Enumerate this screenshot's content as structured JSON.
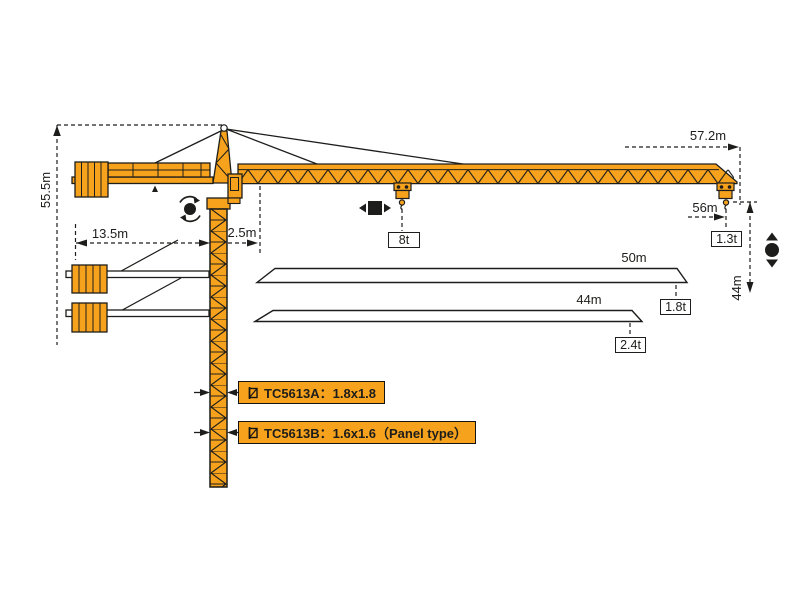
{
  "dims": {
    "height_total": "55.5m",
    "counterjib_radius": "13.5m",
    "jib_root_offset": "2.5m",
    "jib_length_max": "57.2m",
    "working_radius_max": "56m",
    "jib_length_mid": "50m",
    "jib_length_short": "44m",
    "hook_height": "44m"
  },
  "loads": {
    "max_at_trolley": "8t",
    "tip_57m": "1.3t",
    "tip_50m": "1.8t",
    "tip_44m": "2.4t"
  },
  "models": {
    "a": "TC5613A：1.8x1.8",
    "b": "TC5613B：1.6x1.6（Panel type）"
  },
  "colors": {
    "crane_orange": "#F7A21C",
    "line_ink": "#1D1D1B",
    "background": "#FFFFFF"
  },
  "icons": {
    "rotation": "slew-rotation-icon",
    "trolley": "trolley-travel-icon",
    "hoist": "hook-hoist-icon",
    "mast_section": "mast-section-icon"
  }
}
